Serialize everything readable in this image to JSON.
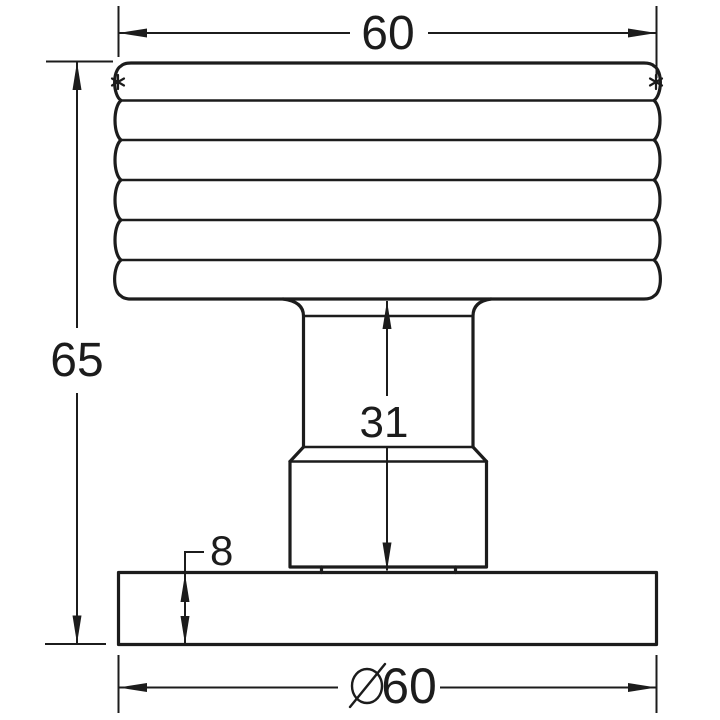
{
  "figure": {
    "background": "#ffffff",
    "line_color": "#1c1c1c",
    "dimensions": {
      "knob_width": "60",
      "overall_height": "65",
      "stem_height": "31",
      "base_thickness": "8",
      "base_diameter": "60",
      "diameter_symbol": "⌀"
    },
    "marks": {
      "left": "*",
      "right": "*"
    }
  }
}
